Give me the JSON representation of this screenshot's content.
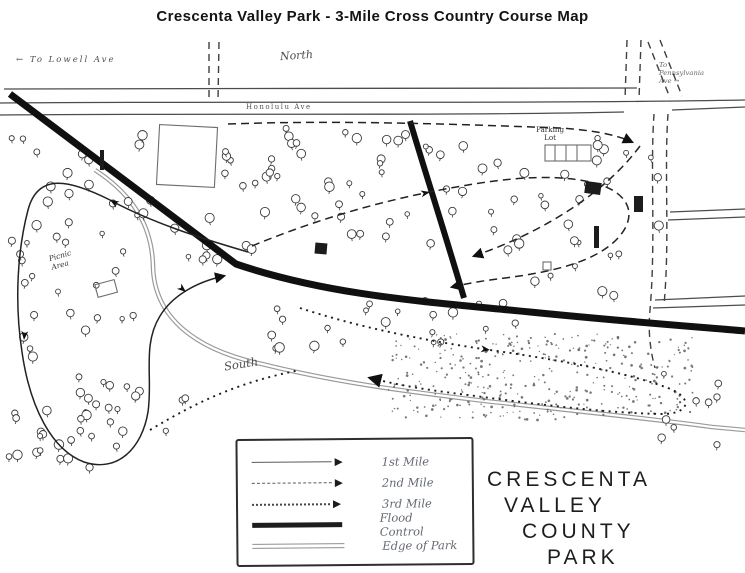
{
  "title": "Crescenta Valley Park  -  3-Mile Cross Country Course Map",
  "map_labels": {
    "to_lowell": "← To Lowell Ave",
    "north": "North",
    "honolulu": "Honolulu Ave",
    "to_pennsylvania": "To\nPennsylvania\nAve →",
    "parking": "Parking\nLot",
    "picnic": "Picnic\nArea",
    "south": "South"
  },
  "legend": {
    "items": [
      {
        "style": "solid-arrow",
        "label": "1st Mile"
      },
      {
        "style": "dashed-arrow",
        "label": "2nd Mile"
      },
      {
        "style": "dotted-arrow",
        "label": "3rd Mile"
      },
      {
        "style": "thick-line",
        "label": "Flood Control"
      },
      {
        "style": "double-line",
        "label": "Edge of Park"
      }
    ]
  },
  "park_name": {
    "lines": [
      "CRESCENTA",
      "VALLEY",
      "COUNTY",
      "PARK"
    ]
  },
  "colors": {
    "ink": "#101010",
    "road": "#4c4c4c",
    "edge_gray": "#9a9a9a"
  }
}
